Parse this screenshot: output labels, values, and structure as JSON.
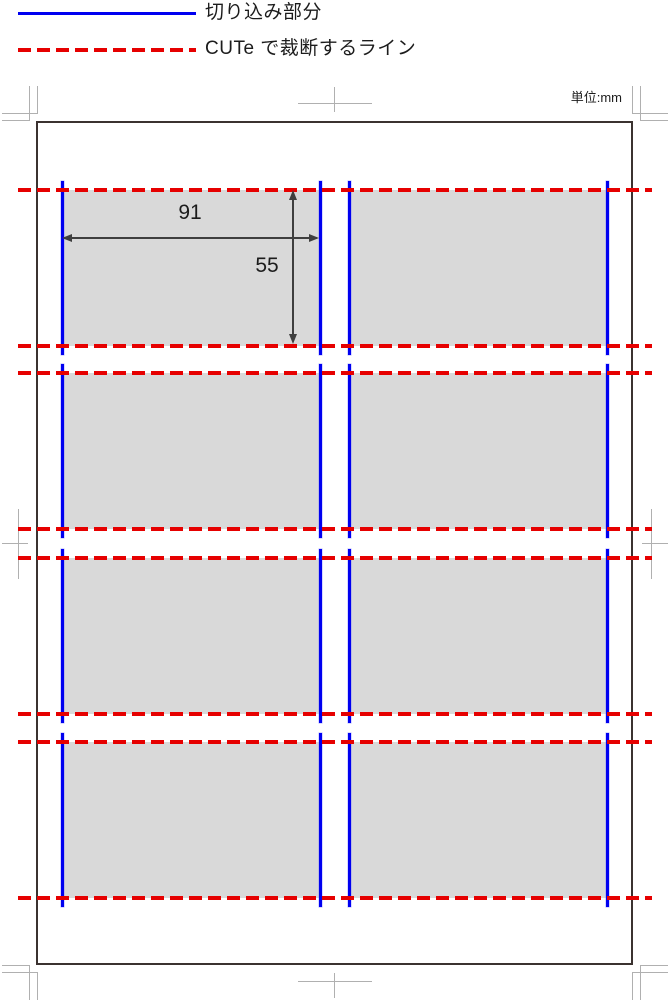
{
  "legend": {
    "notch_label": "切り込み部分",
    "cut_label": "CUTe で裁断するライン"
  },
  "unit_label": "単位:mm",
  "card": {
    "width_mm": "91",
    "height_mm": "55"
  },
  "grid": {
    "rows": 4,
    "columns": 2
  },
  "colors": {
    "notch_blue": "#0000f0",
    "cut_red": "#e60000",
    "card_fill": "#d9d9d9",
    "page_border": "#3b3230",
    "trim_mark_gray": "#b0b0b0",
    "dimension_gray": "#3f3f3f",
    "text": "#1c1c1c"
  }
}
